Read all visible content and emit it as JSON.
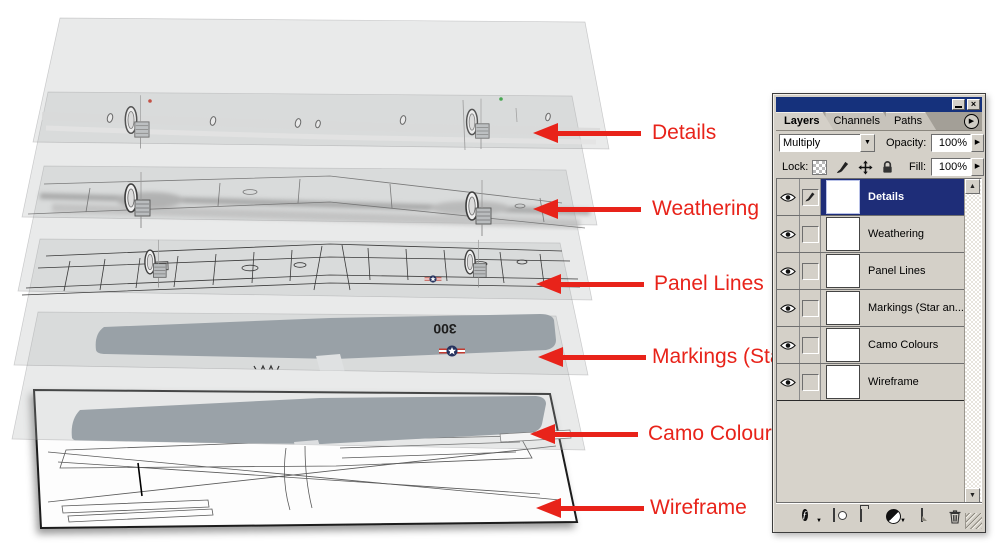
{
  "annotations": {
    "arrow_color": "#e8231a",
    "labels": [
      {
        "text": "Details"
      },
      {
        "text": "Weathering"
      },
      {
        "text": "Panel Lines"
      },
      {
        "text": "Markings (Star"
      },
      {
        "text": "Camo Colours"
      },
      {
        "text": "Wireframe"
      }
    ]
  },
  "artwork": {
    "wing_number": "300"
  },
  "palette": {
    "tabs": [
      {
        "label": "Layers",
        "active": true
      },
      {
        "label": "Channels",
        "active": false
      },
      {
        "label": "Paths",
        "active": false
      }
    ],
    "blend_mode": "Multiply",
    "opacity": {
      "label": "Opacity:",
      "value": "100%"
    },
    "lock": {
      "label": "Lock:"
    },
    "fill": {
      "label": "Fill:",
      "value": "100%"
    },
    "layers": [
      {
        "name": "Details",
        "selected": true
      },
      {
        "name": "Weathering",
        "selected": false
      },
      {
        "name": "Panel Lines",
        "selected": false
      },
      {
        "name": "Markings (Star an...",
        "selected": false
      },
      {
        "name": "Camo Colours",
        "selected": false
      },
      {
        "name": "Wireframe",
        "selected": false
      }
    ]
  }
}
